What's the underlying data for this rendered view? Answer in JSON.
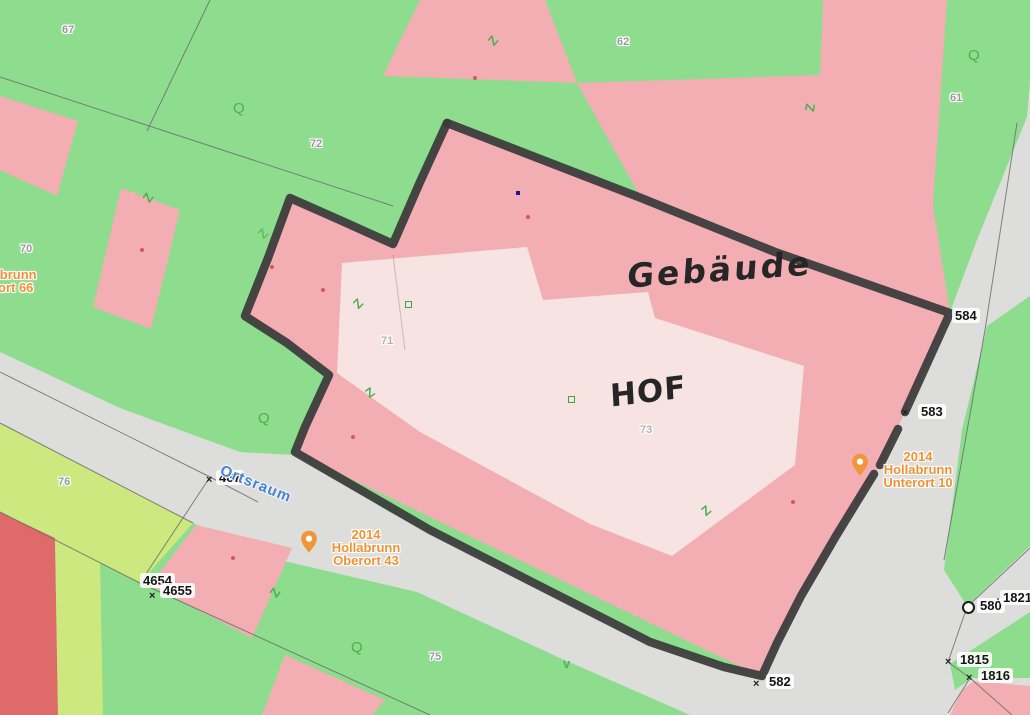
{
  "map": {
    "type": "cadastral-map-scan",
    "municipality_hint": "Hollabrunn",
    "handwriting": {
      "gebaeude": "Gebäude",
      "hof": "HOF"
    },
    "street": {
      "name": "Ortsraum"
    },
    "addresses": {
      "oberort": {
        "line1": "2014 Hollabrunn",
        "line2": "Oberort 43"
      },
      "unterort": {
        "line1": "2014 Hollabrunn",
        "line2": "Unterort 10"
      },
      "ort66_clipped": {
        "line1": "Hollabrunn",
        "line2": "ort 66"
      }
    },
    "parcel_numbers": {
      "p67": "67",
      "p72": "72",
      "p62": "62",
      "p61": "61",
      "p70": "70",
      "p71": "71",
      "p73": "73",
      "p76": "76",
      "p75": "75"
    },
    "survey_points": {
      "s584": "584",
      "s583": "583",
      "s582": "582",
      "s4654": "4654",
      "s4655": "4655",
      "s467": "467",
      "s580": "580",
      "s1821": "1821",
      "s1815": "1815",
      "s1816": "1816"
    },
    "glyphs": {
      "z": "Z",
      "q": "Q",
      "v": "v",
      "cross": "×"
    },
    "colors": {
      "grass_green": "#8edc8e",
      "building_pink": "#f2aeb2",
      "courtyard_light": "#f6e3e2",
      "road_gray": "#dddddc",
      "lime_parcel": "#cde87e",
      "dark_red_parcel": "#df6a6a",
      "marker_black": "#3a3a3a",
      "symbol_green": "#4eb04e",
      "address_orange": "#ef9234",
      "street_blue": "#4484d4"
    }
  }
}
